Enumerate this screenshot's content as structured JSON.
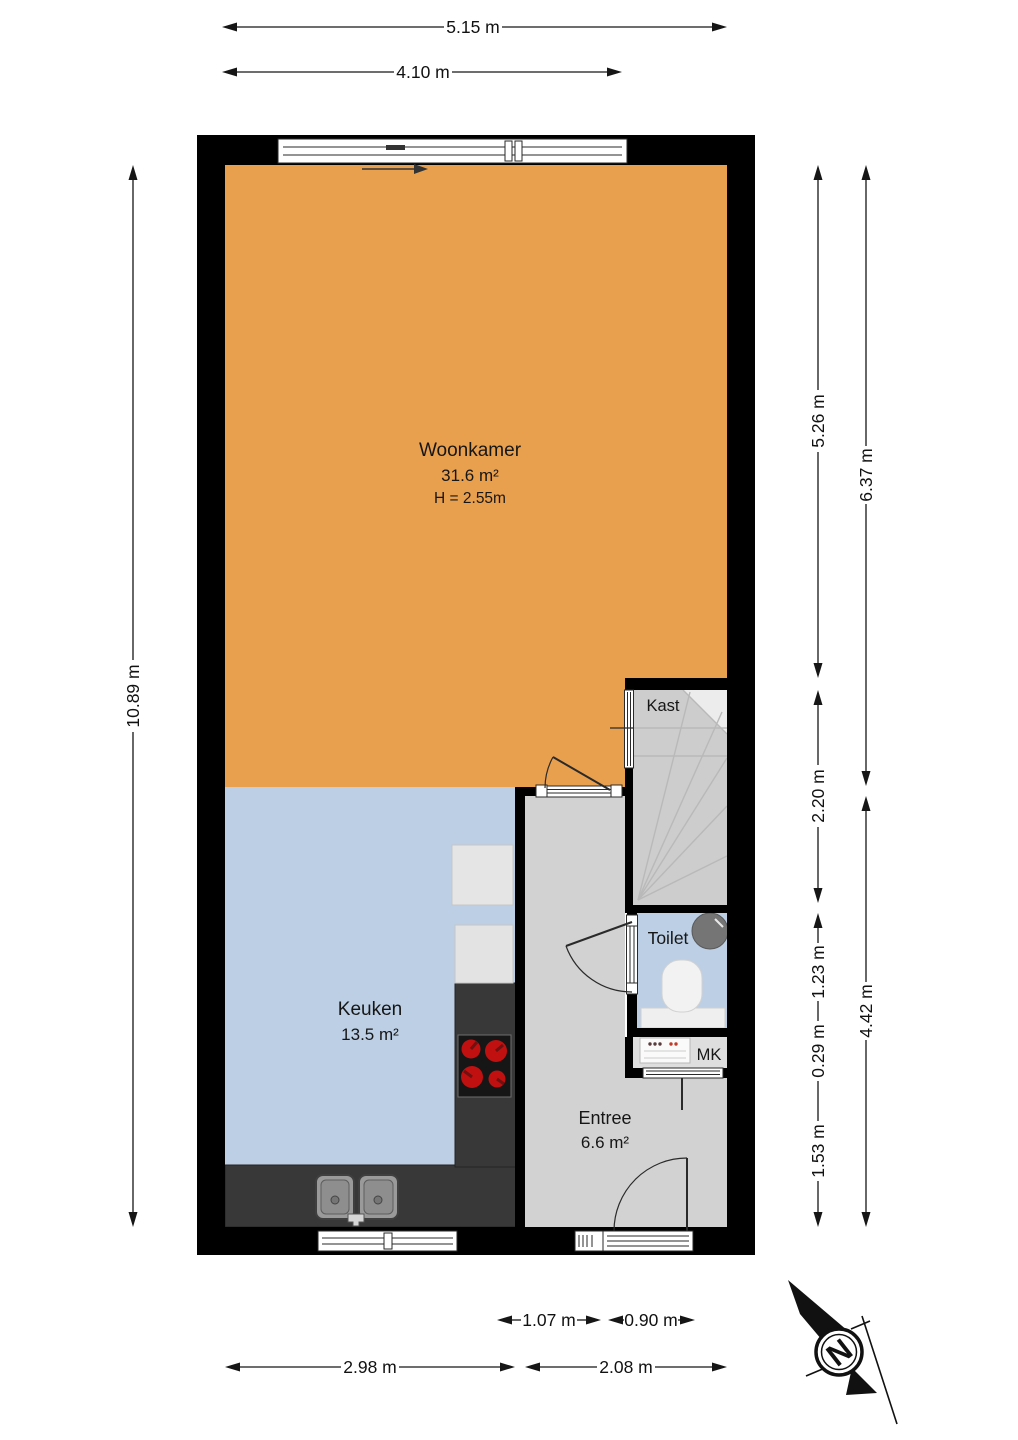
{
  "rooms": {
    "woonkamer": {
      "name": "Woonkamer",
      "area": "31.6 m²",
      "ceiling_height": "H = 2.55m"
    },
    "keuken": {
      "name": "Keuken",
      "area": "13.5 m²"
    },
    "entree": {
      "name": "Entree",
      "area": "6.6 m²"
    },
    "kast": {
      "name": "Kast"
    },
    "toilet": {
      "name": "Toilet"
    },
    "meterkast": {
      "name": "MK"
    }
  },
  "dimensions": {
    "top_outer": "5.15 m",
    "top_inner": "4.10 m",
    "left_total": "10.89 m",
    "right_inner": {
      "woonkamer": "5.26 m",
      "kast": "2.20 m",
      "toilet": "1.23 m",
      "mk": "0.29 m",
      "entree": "1.53 m"
    },
    "right_outer": {
      "upper": "6.37 m",
      "lower": "4.42 m"
    },
    "bottom_inner": {
      "hall_window": "1.07 m",
      "front_door": "0.90 m"
    },
    "bottom_outer": {
      "keuken": "2.98 m",
      "entree": "2.08 m"
    }
  },
  "compass": {
    "north_label": "N"
  },
  "colors": {
    "woonkamer_floor": "#E9A04E",
    "keuken_toilet_floor": "#BCCFE4",
    "hall_floor": "#D2D2D2",
    "stairs_floor": "#CDCDCD",
    "wall": "#000000",
    "counter_dark": "#383838",
    "appliance_light": "#E5E5E5",
    "burner_red": "#C01010"
  }
}
